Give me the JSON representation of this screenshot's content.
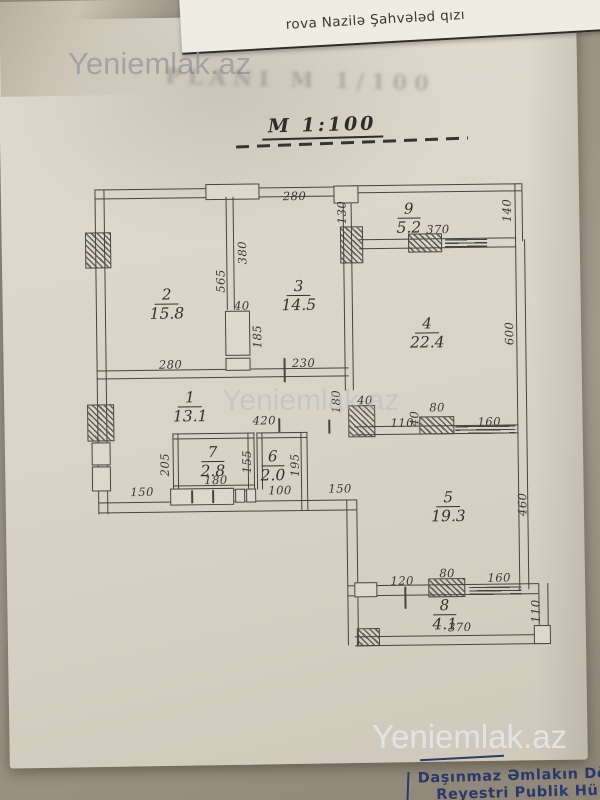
{
  "header": {
    "owner_name": "rova Nazilə Şahvələd qızı",
    "ghost_title": "PLANI M 1/100"
  },
  "watermark": {
    "top": "Yeniemlak.az",
    "middle": "Yeniemlak.az",
    "bottom": "Yeniemlak.az"
  },
  "scale_label": "M 1:100",
  "footer": {
    "line1": "Daşınmaz Əmlakın Dövlə",
    "line2": "Reyestri Publik Hü"
  },
  "colors": {
    "paper": "#dcd7cb",
    "ink": "#46443f",
    "footer_blue": "#2c3867",
    "watermark_gray": "#b9b9c0"
  },
  "plan": {
    "rooms": [
      {
        "num": "2",
        "area": "15.8",
        "x": 168,
        "y": 283
      },
      {
        "num": "3",
        "area": "14.5",
        "x": 300,
        "y": 276
      },
      {
        "num": "9",
        "area": "5.2",
        "x": 411,
        "y": 200
      },
      {
        "num": "4",
        "area": "22.4",
        "x": 428,
        "y": 315
      },
      {
        "num": "1",
        "area": "13.1",
        "x": 190,
        "y": 386
      },
      {
        "num": "7",
        "area": "2.8",
        "x": 212,
        "y": 441
      },
      {
        "num": "6",
        "area": "2.0",
        "x": 272,
        "y": 446
      },
      {
        "num": "5",
        "area": "19.3",
        "x": 447,
        "y": 489
      },
      {
        "num": "8",
        "area": "4.1",
        "x": 442,
        "y": 597
      }
    ],
    "dims": [
      {
        "t": "280",
        "x": 297,
        "y": 196,
        "v": 0
      },
      {
        "t": "130",
        "x": 344,
        "y": 213,
        "v": 1
      },
      {
        "t": "370",
        "x": 440,
        "y": 231,
        "v": 0
      },
      {
        "t": "140",
        "x": 509,
        "y": 213,
        "v": 1
      },
      {
        "t": "380",
        "x": 244,
        "y": 252,
        "v": 1
      },
      {
        "t": "565",
        "x": 222,
        "y": 280,
        "v": 1
      },
      {
        "t": "40",
        "x": 243,
        "y": 305,
        "v": 0
      },
      {
        "t": "185",
        "x": 258,
        "y": 336,
        "v": 1
      },
      {
        "t": "280",
        "x": 171,
        "y": 363,
        "v": 0
      },
      {
        "t": "230",
        "x": 304,
        "y": 363,
        "v": 0
      },
      {
        "t": "600",
        "x": 510,
        "y": 336,
        "v": 1
      },
      {
        "t": "180",
        "x": 336,
        "y": 402,
        "v": 1
      },
      {
        "t": "40",
        "x": 365,
        "y": 401,
        "v": 0
      },
      {
        "t": "420",
        "x": 264,
        "y": 420,
        "v": 0
      },
      {
        "t": "110",
        "x": 402,
        "y": 424,
        "v": 0
      },
      {
        "t": "40",
        "x": 414,
        "y": 420,
        "v": 1
      },
      {
        "t": "80",
        "x": 437,
        "y": 409,
        "v": 0
      },
      {
        "t": "160",
        "x": 489,
        "y": 424,
        "v": 0
      },
      {
        "t": "205",
        "x": 164,
        "y": 463,
        "v": 1
      },
      {
        "t": "155",
        "x": 246,
        "y": 461,
        "v": 1
      },
      {
        "t": "195",
        "x": 294,
        "y": 465,
        "v": 1
      },
      {
        "t": "180",
        "x": 215,
        "y": 479,
        "v": 0
      },
      {
        "t": "150",
        "x": 141,
        "y": 490,
        "v": 0
      },
      {
        "t": "100",
        "x": 279,
        "y": 490,
        "v": 0
      },
      {
        "t": "150",
        "x": 339,
        "y": 489,
        "v": 0
      },
      {
        "t": "460",
        "x": 521,
        "y": 507,
        "v": 1
      },
      {
        "t": "120",
        "x": 400,
        "y": 582,
        "v": 0
      },
      {
        "t": "80",
        "x": 445,
        "y": 575,
        "v": 0
      },
      {
        "t": "160",
        "x": 497,
        "y": 580,
        "v": 0
      },
      {
        "t": "110",
        "x": 533,
        "y": 614,
        "v": 1
      },
      {
        "t": "370",
        "x": 457,
        "y": 629,
        "v": 0
      }
    ]
  }
}
